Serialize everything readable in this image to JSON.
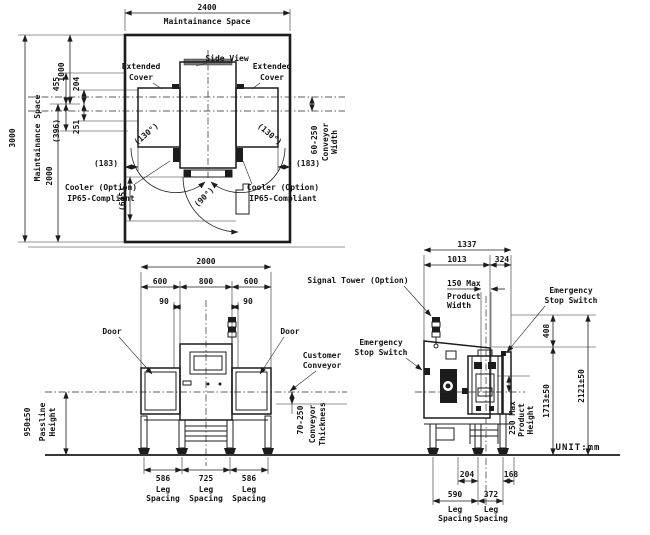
{
  "colors": {
    "line": "#1c1c1c",
    "dark_fill": "#1c1c1c",
    "gray_bar": "#787878",
    "background": "#ffffff"
  },
  "unit": "UNIT:mm",
  "plan": {
    "w2400": "2400",
    "space_top": "Maintainance Space",
    "space_left": "Maintainance Space",
    "h3000": "3000",
    "h2000": "2000",
    "h1000": "1000",
    "d455": "455",
    "d204": "204",
    "d396": "(396)",
    "d251": "251",
    "d183l": "(183)",
    "d183r": "(183)",
    "a130l": "(130°)",
    "a130r": "(130°)",
    "a90": "(90°)",
    "d645": "(645)",
    "ext1": "Extended",
    "ext2": "Cover",
    "view": "Side View",
    "cw1": "60-250",
    "cw2": "Conveyor",
    "cw3": "Width",
    "cool1": "Cooler (Option)",
    "cool2": "IP65-Compliant"
  },
  "front": {
    "w2000": "2000",
    "s600l": "600",
    "s800": "800",
    "s600r": "600",
    "o90l": "90",
    "o90r": "90",
    "doorl": "Door",
    "doorr": "Door",
    "cc1": "Customer",
    "cc2": "Conveyor",
    "pl_val": "950±50",
    "pl1": "Passline",
    "pl2": "Height",
    "ct_val": "70-250",
    "ct1": "Conveyor",
    "ct2": "Thickness",
    "ls1": "586",
    "ls2": "725",
    "ls3": "586",
    "leg1": "Leg",
    "leg2": "Spacing"
  },
  "side": {
    "d1337": "1337",
    "d1013": "1013",
    "d324": "324",
    "signal_tower": "Signal Tower (Option)",
    "pw1": "150 Max",
    "pw2": "Product",
    "pw3": "Width",
    "es1": "Emergency",
    "es2": "Stop Switch",
    "d408": "408",
    "h1713": "1713±50",
    "h2121": "2121±50",
    "ph1": "250 Max",
    "ph2": "Product",
    "ph3": "Height",
    "d204": "204",
    "d168": "168",
    "d590": "590",
    "d372": "372",
    "leg1": "Leg",
    "leg2": "Spacing"
  }
}
